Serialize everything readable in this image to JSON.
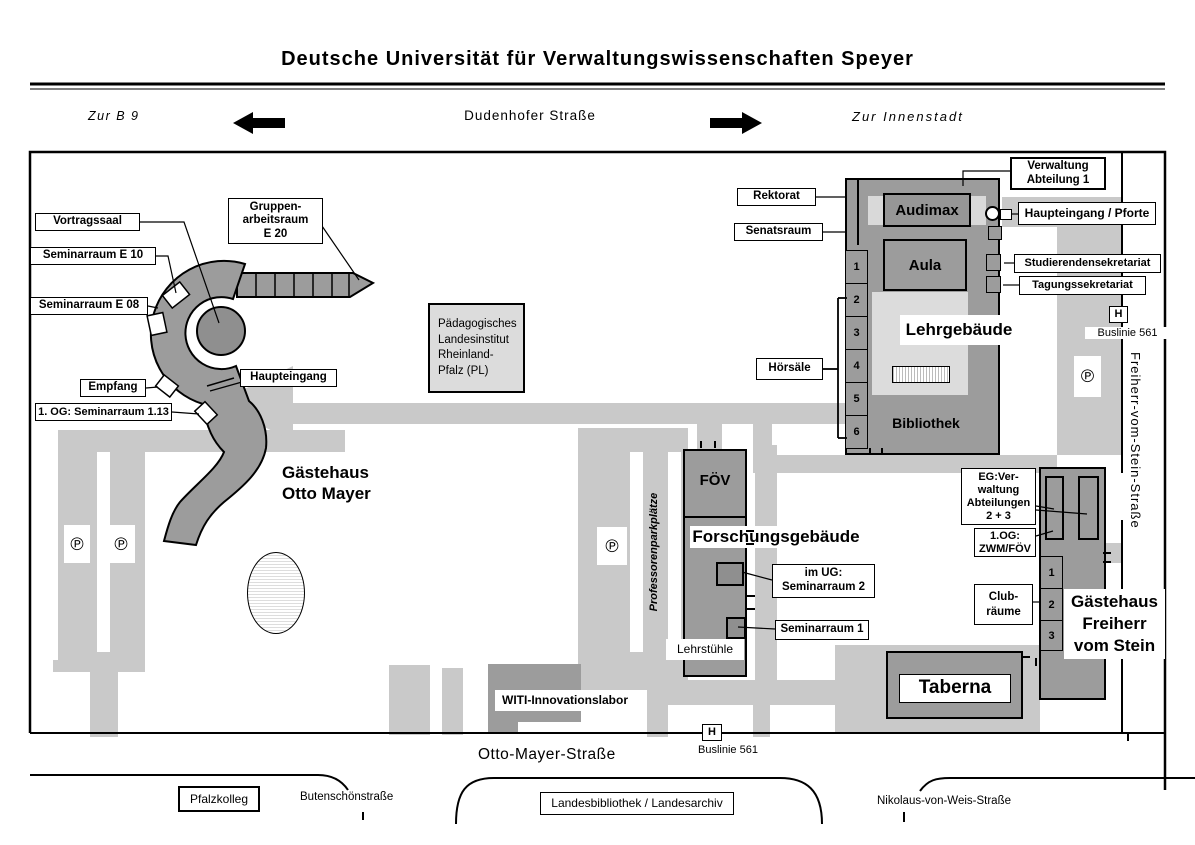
{
  "title": "Deutsche Universität für Verwaltungswissenschaften Speyer",
  "header": {
    "zur_b9": "Zur B 9",
    "dudenhofer": "Dudenhofer Straße",
    "zur_innenstadt": "Zur Innenstadt"
  },
  "otto_mayer_area": {
    "name_l1": "Gästehaus",
    "name_l2": "Otto Mayer",
    "vortragssaal": "Vortragssaal",
    "seminarraum_e10": "Seminarraum E 10",
    "seminarraum_e08": "Seminarraum E 08",
    "empfang": "Empfang",
    "og_seminarraum": "1. OG: Seminarraum 1.13",
    "haupteingang": "Haupteingang",
    "gruppenraum_l1": "Gruppen-",
    "gruppenraum_l2": "arbeitsraum",
    "gruppenraum_l3": "E 20"
  },
  "paedagogisches": {
    "l1": "Pädagogisches",
    "l2": "Landesinstitut",
    "l3": "Rheinland-",
    "l4": "Pfalz (PL)"
  },
  "lehrgebaeude": {
    "name": "Lehrgebäude",
    "audimax": "Audimax",
    "aula": "Aula",
    "bibliothek": "Bibliothek",
    "rektorat": "Rektorat",
    "senatsraum": "Senatsraum",
    "hoersaele": "Hörsäle",
    "verwaltung_l1": "Verwaltung",
    "verwaltung_l2": "Abteilung 1",
    "haupteingang_pforte": "Haupteingang / Pforte",
    "studierendensekretariat": "Studierendensekretariat",
    "tagungssekretariat": "Tagungssekretariat",
    "hoersaal_numbers": [
      "1",
      "2",
      "3",
      "4",
      "5",
      "6"
    ]
  },
  "forschung": {
    "foev": "FÖV",
    "name": "Forschungsgebäude",
    "im_ug_l1": "im UG:",
    "im_ug_l2": "Seminarraum 2",
    "seminarraum1": "Seminarraum 1",
    "lehrstuehle": "Lehrstühle",
    "professorenparkplaetze": "Professorenparkplätze"
  },
  "freiherr_vom_stein": {
    "street": "Freiherr-vom-Stein-Straße",
    "name_l1": "Gästehaus",
    "name_l2": "Freiherr",
    "name_l3": "vom Stein",
    "eg_l1": "EG:Ver-",
    "eg_l2": "waltung",
    "eg_l3": "Abteilungen",
    "eg_l4": "2 + 3",
    "og_l1": "1.OG:",
    "og_l2": "ZWM/FÖV",
    "club_l1": "Club-",
    "club_l2": "räume",
    "numbers": [
      "1",
      "2",
      "3"
    ]
  },
  "taberna": "Taberna",
  "witi": "WITI-Innovationslabor",
  "transit": {
    "h": "H",
    "buslinie": "Buslinie 561"
  },
  "parking": {
    "symbol": "℗"
  },
  "south": {
    "otto_mayer_strasse": "Otto-Mayer-Straße",
    "pfalzkolleg": "Pfalzkolleg",
    "butenschoenstrasse": "Butenschönstraße",
    "landesbibliothek": "Landesbibliothek / Landesarchiv",
    "nikolaus": "Nikolaus-von-Weis-Straße"
  },
  "colors": {
    "building": "#9c9c9c",
    "building_dark": "#8f8f8f",
    "path": "#c9c9c9",
    "light_area": "#dcdcdc"
  }
}
